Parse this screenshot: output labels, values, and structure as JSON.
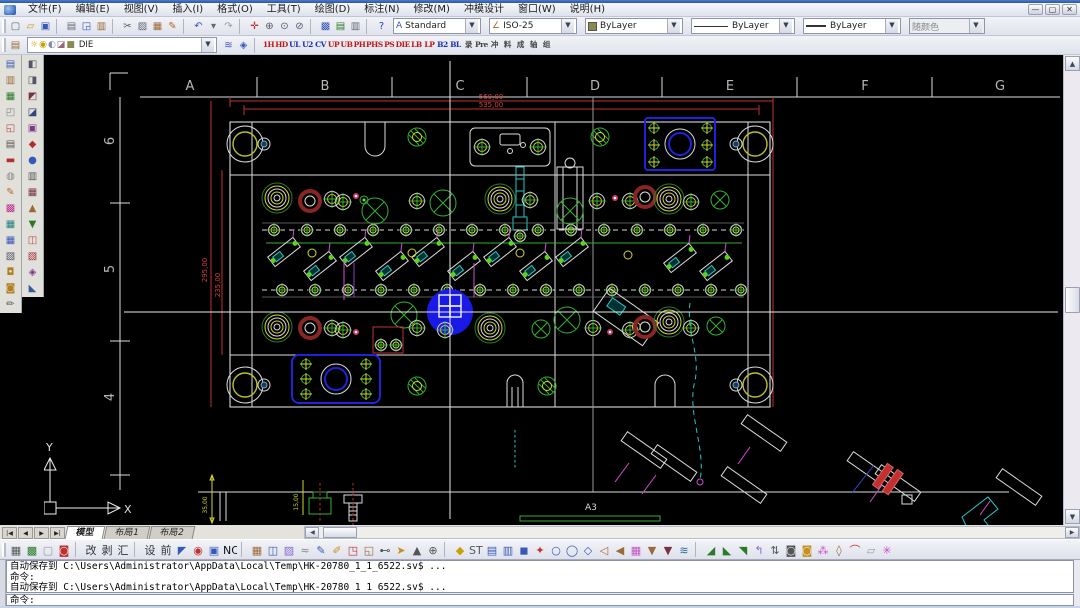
{
  "window": {
    "controls": [
      {
        "n": "minimize-button",
        "t": "—"
      },
      {
        "n": "restore-button",
        "t": "▢"
      },
      {
        "n": "close-button",
        "t": "✕"
      }
    ]
  },
  "menu": {
    "items": [
      "文件(F)",
      "编辑(E)",
      "视图(V)",
      "插入(I)",
      "格式(O)",
      "工具(T)",
      "绘图(D)",
      "标注(N)",
      "修改(M)",
      "冲模设计",
      "窗口(W)",
      "说明(H)"
    ]
  },
  "toolbar1": {
    "icons": [
      {
        "n": "new-icon",
        "t": "▢",
        "c": "#667"
      },
      {
        "n": "open-icon",
        "t": "▱",
        "c": "#c89020"
      },
      {
        "n": "save-icon",
        "t": "▣",
        "c": "#3858b8"
      },
      {
        "s": 1
      },
      {
        "n": "plot-icon",
        "t": "▤",
        "c": "#667"
      },
      {
        "n": "preview-icon",
        "t": "◲",
        "c": "#3858b8"
      },
      {
        "n": "publish-icon",
        "t": "▥",
        "c": "#9a6a3a"
      },
      {
        "s": 1
      },
      {
        "n": "cut-icon",
        "t": "✂",
        "c": "#555"
      },
      {
        "n": "copy-icon",
        "t": "▨",
        "c": "#667"
      },
      {
        "n": "paste-icon",
        "t": "▦",
        "c": "#9a6a3a"
      },
      {
        "n": "matchprop-icon",
        "t": "✎",
        "c": "#b06a20"
      },
      {
        "s": 1
      },
      {
        "n": "undo-icon",
        "t": "↶",
        "c": "#3858b8"
      },
      {
        "n": "undo-drop-icon",
        "t": "▾",
        "c": "#667"
      },
      {
        "n": "redo-icon",
        "t": "↷",
        "c": "#99a"
      },
      {
        "s": 1
      },
      {
        "n": "pan-icon",
        "t": "✛",
        "c": "#c03030"
      },
      {
        "n": "zoom-realtime-icon",
        "t": "⊕",
        "c": "#556"
      },
      {
        "n": "zoom-window-icon",
        "t": "⊙",
        "c": "#556"
      },
      {
        "n": "zoom-previous-icon",
        "t": "⊘",
        "c": "#556"
      },
      {
        "s": 1
      },
      {
        "n": "toolpalette-icon",
        "t": "▩",
        "c": "#3858b8"
      },
      {
        "n": "sheetset-icon",
        "t": "▤",
        "c": "#2a7a2a"
      },
      {
        "n": "markup-icon",
        "t": "▥",
        "c": "#667"
      },
      {
        "s": 1
      },
      {
        "n": "help-icon",
        "t": "?",
        "c": "#2040c0"
      }
    ],
    "text_style": "Standard",
    "dim_style": "ISO-25",
    "color": "ByLayer",
    "linetype": "ByLayer",
    "lineweight": "ByLayer",
    "plot_style": "随颜色",
    "dropdown_arrow": "▼"
  },
  "layers": {
    "manager_icon": {
      "n": "layer-manager-icon",
      "t": "▤",
      "c": "#9a6a3a"
    },
    "state_glyphs": [
      {
        "n": "layer-on-icon",
        "t": "☼",
        "c": "#c8a000"
      },
      {
        "n": "layer-freeze-icon",
        "t": "◉",
        "c": "#c8a000"
      },
      {
        "n": "layer-lock-icon",
        "t": "◐",
        "c": "#88a"
      },
      {
        "n": "layer-plot-icon",
        "t": "◪",
        "c": "#967"
      },
      {
        "n": "layer-color-icon",
        "t": "■",
        "c": "#8a8a50"
      }
    ],
    "current": "DIE",
    "right_icons": [
      {
        "n": "make-object-layer-icon",
        "t": "≋",
        "c": "#3858b8"
      },
      {
        "n": "layer-states-icon",
        "t": "◈",
        "c": "#3858b8"
      }
    ]
  },
  "die_toolbar": {
    "items": [
      {
        "n": "die-tool-1h",
        "t": "1H",
        "c": "#c01818"
      },
      {
        "n": "die-tool-hd",
        "t": "HD",
        "c": "#c01818"
      },
      {
        "n": "die-tool-ul",
        "t": "UL",
        "c": "#1830b8"
      },
      {
        "n": "die-tool-u2",
        "t": "U2",
        "c": "#1830b8"
      },
      {
        "n": "die-tool-cv",
        "t": "CV",
        "c": "#1830b8"
      },
      {
        "n": "die-tool-up",
        "t": "UP",
        "c": "#c01818"
      },
      {
        "n": "die-tool-ub",
        "t": "UB",
        "c": "#c01818"
      },
      {
        "n": "die-tool-ph",
        "t": "PH",
        "c": "#c01818"
      },
      {
        "n": "die-tool-phs",
        "t": "PHS",
        "c": "#c01818"
      },
      {
        "n": "die-tool-ps",
        "t": "PS",
        "c": "#c01818"
      },
      {
        "n": "die-tool-die",
        "t": "DIE",
        "c": "#c01818"
      },
      {
        "n": "die-tool-lb",
        "t": "LB",
        "c": "#c01818"
      },
      {
        "n": "die-tool-lp",
        "t": "LP",
        "c": "#c01818"
      },
      {
        "n": "die-tool-b2",
        "t": "B2",
        "c": "#1830b8"
      },
      {
        "n": "die-tool-bl",
        "t": "BL",
        "c": "#1830b8"
      },
      {
        "n": "die-tool-lu",
        "t": "录",
        "c": "#444"
      },
      {
        "n": "die-tool-pre",
        "t": "Pre",
        "c": "#444"
      },
      {
        "n": "die-tool-chong",
        "t": "冲",
        "c": "#444"
      },
      {
        "n": "die-tool-liao",
        "t": "料",
        "c": "#444"
      },
      {
        "n": "die-tool-cheng",
        "t": "成",
        "c": "#444"
      },
      {
        "n": "die-tool-zhou",
        "t": "轴",
        "c": "#444"
      },
      {
        "n": "die-tool-zu",
        "t": "组",
        "c": "#444"
      }
    ]
  },
  "left_toolbar_1": [
    {
      "n": "lt-properties-icon",
      "t": "▤",
      "c": "#3858b8"
    },
    {
      "n": "lt-layers-icon",
      "t": "▥",
      "c": "#9a6a3a"
    },
    {
      "n": "lt-book-icon",
      "t": "▦",
      "c": "#2a7a2a"
    },
    {
      "n": "lt-copy-icon",
      "t": "◰",
      "c": "#888"
    },
    {
      "n": "lt-stamp-icon",
      "t": "◱",
      "c": "#b05050"
    },
    {
      "n": "lt-list-icon",
      "t": "▤",
      "c": "#555"
    },
    {
      "n": "lt-band-icon",
      "t": "▬",
      "c": "#b03030"
    },
    {
      "n": "lt-ois-icon",
      "t": "◍",
      "c": "#888"
    },
    {
      "n": "lt-brush-icon",
      "t": "✎",
      "c": "#b06a20"
    },
    {
      "n": "lt-palette-icon",
      "t": "▩",
      "c": "#c03090"
    },
    {
      "n": "lt-chip-icon",
      "t": "▦",
      "c": "#208080"
    },
    {
      "n": "lt-grid-icon",
      "t": "▦",
      "c": "#3858b8"
    },
    {
      "n": "lt-sheets-icon",
      "t": "▧",
      "c": "#556"
    },
    {
      "n": "lt-lock-icon",
      "t": "◘",
      "c": "#b08020"
    },
    {
      "n": "lt-unlock-icon",
      "t": "◙",
      "c": "#b08020"
    },
    {
      "n": "lt-pen-icon",
      "t": "✏",
      "c": "#555"
    }
  ],
  "left_toolbar_2": [
    {
      "n": "dt-plate-icon",
      "t": "◧",
      "c": "#556"
    },
    {
      "n": "dt-punch-icon",
      "t": "◨",
      "c": "#556"
    },
    {
      "n": "dt-insert-icon",
      "t": "◩",
      "c": "#734"
    },
    {
      "n": "dt-strip-icon",
      "t": "◪",
      "c": "#347"
    },
    {
      "n": "dt-pilot-icon",
      "t": "▣",
      "c": "#7a3a8a"
    },
    {
      "n": "dt-spring-icon",
      "t": "◆",
      "c": "#b03030"
    },
    {
      "n": "dt-cloud-icon",
      "t": "●",
      "c": "#3858b8"
    },
    {
      "n": "dt-guide-icon",
      "t": "▥",
      "c": "#555"
    },
    {
      "n": "dt-block-icon",
      "t": "▦",
      "c": "#734"
    },
    {
      "n": "dt-rail-icon",
      "t": "▲",
      "c": "#9a6a3a"
    },
    {
      "n": "dt-lift-icon",
      "t": "▼",
      "c": "#2a7a2a"
    },
    {
      "n": "dt-screw-icon",
      "t": "◫",
      "c": "#b05050"
    },
    {
      "n": "dt-dowel-icon",
      "t": "▧",
      "c": "#a03030"
    },
    {
      "n": "dt-wire-icon",
      "t": "◈",
      "c": "#7a3a8a"
    },
    {
      "n": "dt-edge-icon",
      "t": "◣",
      "c": "#345a9a"
    }
  ],
  "tabs": {
    "nav": [
      {
        "n": "tab-first-button",
        "t": "|◀"
      },
      {
        "n": "tab-prev-button",
        "t": "◀"
      },
      {
        "n": "tab-next-button",
        "t": "▶"
      },
      {
        "n": "tab-last-button",
        "t": "▶|"
      }
    ],
    "items": [
      {
        "n": "tab-model",
        "t": "模型",
        "a": 1
      },
      {
        "n": "tab-layout1",
        "t": "布局1"
      },
      {
        "n": "tab-layout2",
        "t": "布局2"
      }
    ]
  },
  "toolbar3": {
    "group_a": [
      {
        "n": "bt-render-icon",
        "t": "▦",
        "c": "#555"
      },
      {
        "n": "bt-material-icon",
        "t": "▩",
        "c": "#2a7a2a"
      },
      {
        "n": "bt-blank-icon",
        "t": "▢",
        "c": "#999"
      },
      {
        "n": "bt-target-icon",
        "t": "◙",
        "c": "#c03030"
      },
      {
        "s": 1
      },
      {
        "n": "bt-gai",
        "t": "改",
        "c": "#333"
      },
      {
        "n": "bt-bo",
        "t": "剥",
        "c": "#333"
      },
      {
        "n": "bt-hui",
        "t": "汇",
        "c": "#333"
      },
      {
        "s": 1
      },
      {
        "n": "bt-she",
        "t": "设",
        "c": "#333"
      },
      {
        "n": "bt-qian",
        "t": "前",
        "c": "#333"
      },
      {
        "n": "bt-corner-icon",
        "t": "◤",
        "c": "#3858b8"
      },
      {
        "n": "bt-reddot-icon",
        "t": "◉",
        "c": "#c03030"
      },
      {
        "n": "bt-bluebox-icon",
        "t": "▣",
        "c": "#3858b8"
      },
      {
        "n": "bt-nc",
        "t": "NC",
        "c": "#111"
      }
    ],
    "group_b": [
      {
        "n": "bt-cabinet-icon",
        "t": "▦",
        "c": "#9a6a3a"
      },
      {
        "n": "bt-view-icon",
        "t": "◫",
        "c": "#3858b8"
      },
      {
        "n": "bt-purple-icon",
        "t": "▨",
        "c": "#86c"
      },
      {
        "n": "bt-eq-icon",
        "t": "≈",
        "c": "#888"
      },
      {
        "n": "bt-pen1-icon",
        "t": "✎",
        "c": "#3858b8"
      },
      {
        "n": "bt-pen2-icon",
        "t": "✐",
        "c": "#c89020"
      },
      {
        "n": "bt-copy2-icon",
        "t": "◳",
        "c": "#c03030"
      },
      {
        "n": "bt-page-icon",
        "t": "◱",
        "c": "#9a6a3a"
      },
      {
        "n": "bt-b6-icon",
        "t": "⊷",
        "c": "#555"
      },
      {
        "n": "bt-hand-icon",
        "t": "➤",
        "c": "#c89020"
      },
      {
        "n": "bt-3d-icon",
        "t": "▲",
        "c": "#555"
      },
      {
        "n": "bt-circleplus-icon",
        "t": "⊕",
        "c": "#555"
      }
    ],
    "group_c": [
      {
        "n": "bt-gold-icon",
        "t": "◆",
        "c": "#c8a000"
      },
      {
        "n": "bt-stl",
        "t": "STl",
        "c": "#556"
      },
      {
        "n": "bt-table-icon",
        "t": "▤",
        "c": "#3858b8"
      },
      {
        "n": "bt-print2-icon",
        "t": "▥",
        "c": "#3858b8"
      },
      {
        "n": "bt-solid-icon",
        "t": "◼",
        "c": "#3858b8"
      },
      {
        "n": "bt-star-icon",
        "t": "✦",
        "c": "#c03030"
      },
      {
        "n": "bt-circ1-icon",
        "t": "○",
        "c": "#3858b8"
      },
      {
        "n": "bt-circ2-icon",
        "t": "◯",
        "c": "#3858b8"
      },
      {
        "n": "bt-diam-icon",
        "t": "◇",
        "c": "#3858b8"
      },
      {
        "n": "bt-spk1-icon",
        "t": "◁",
        "c": "#9a6a3a"
      },
      {
        "n": "bt-spk2-icon",
        "t": "◀",
        "c": "#9a6a3a"
      },
      {
        "n": "bt-grid2-icon",
        "t": "▦",
        "c": "#c44fc4"
      },
      {
        "n": "bt-filter1-icon",
        "t": "▼",
        "c": "#9a6a3a"
      },
      {
        "n": "bt-filter2-icon",
        "t": "▼",
        "c": "#734"
      },
      {
        "n": "bt-land-icon",
        "t": "≋",
        "c": "#2a6a9a"
      }
    ],
    "group_d": [
      {
        "n": "bt-ramp1-icon",
        "t": "◢",
        "c": "#2a7a2a"
      },
      {
        "n": "bt-ramp2-icon",
        "t": "◣",
        "c": "#2a7a2a"
      },
      {
        "n": "bt-ramp3-icon",
        "t": "◥",
        "c": "#2a7a2a"
      },
      {
        "n": "bt-bend-icon",
        "t": "↰",
        "c": "#86c"
      },
      {
        "n": "bt-swap-icon",
        "t": "⇅",
        "c": "#555"
      },
      {
        "n": "bt-oring-icon",
        "t": "◙",
        "c": "#555"
      },
      {
        "n": "bt-oring2-icon",
        "t": "◙",
        "c": "#c89020"
      },
      {
        "n": "bt-burst-icon",
        "t": "⁂",
        "c": "#c44fc4"
      },
      {
        "n": "bt-gem-icon",
        "t": "◊",
        "c": "#9a6a3a"
      },
      {
        "n": "bt-arc-icon",
        "t": "⌒",
        "c": "#c03030"
      },
      {
        "n": "bt-slab-icon",
        "t": "▱",
        "c": "#999"
      },
      {
        "n": "bt-aster-icon",
        "t": "✳",
        "c": "#c44fc4"
      }
    ]
  },
  "command": {
    "history": [
      "自动保存到 C:\\Users\\Administrator\\AppData\\Local\\Temp\\HK-20780_1_1_6522.sv$ ...",
      "命令:",
      "自动保存到 C:\\Users\\Administrator\\AppData\\Local\\Temp\\HK-20780_1_1_6522.sv$ ..."
    ],
    "prompt": "命令:"
  },
  "drawing": {
    "grid_letters": [
      "A",
      "B",
      "C",
      "D",
      "E",
      "F",
      "G"
    ],
    "grid_numbers": [
      "6",
      "5",
      "4"
    ],
    "dim_top": "560,00",
    "dim_top2": "535,00",
    "dim_left": "295,00",
    "dim_left2": "235,00",
    "dim_sec1": "35,00",
    "dim_sec2": "15,00",
    "sheet_label": "A3",
    "ucs_x": "X",
    "ucs_y": "Y",
    "accent_blue": "#2222dd",
    "highlight_blue": "#1a1ae6",
    "dim_red": "#c23030"
  }
}
